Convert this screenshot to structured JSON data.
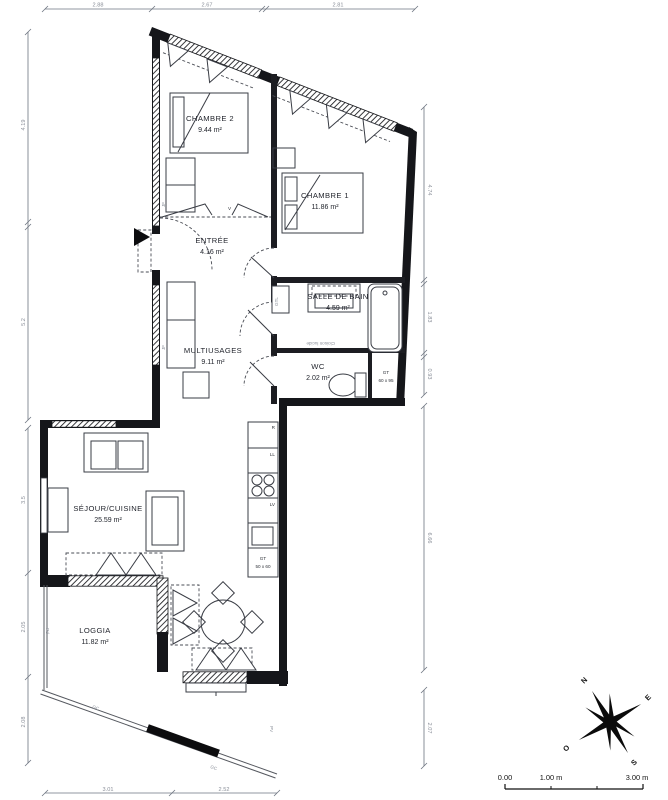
{
  "rooms": {
    "chambre2": {
      "name": "CHAMBRE 2",
      "area": "9.44 m²"
    },
    "chambre1": {
      "name": "CHAMBRE 1",
      "area": "11.86 m²"
    },
    "entree": {
      "name": "ENTRÉE",
      "area": "4.16 m²"
    },
    "salle_de_bain": {
      "name": "SALLE DE BAIN",
      "area": "4.59 m²"
    },
    "wc": {
      "name": "WC",
      "area": "2.02 m²"
    },
    "multiusages": {
      "name": "MULTIUSAGES",
      "area": "9.11 m²"
    },
    "sejour": {
      "name": "SÉJOUR/CUISINE",
      "area": "25.59 m²"
    },
    "loggia": {
      "name": "LOGGIA",
      "area": "11.82 m²"
    }
  },
  "dimensions": {
    "top": [
      "2.88",
      "2.67",
      "2.81"
    ],
    "left": [
      "4.19",
      "5.2",
      "3.5",
      "2.05",
      "2.08"
    ],
    "right": [
      "4.74",
      "1.83",
      "0.93",
      "6.66",
      "2.07"
    ],
    "bottom": [
      "3.01",
      "2.52"
    ]
  },
  "labels": {
    "gtl": "GTL",
    "jf1": "JF",
    "jf2": "JF",
    "pd": "Pd",
    "pv": "PV",
    "gc1": "GC",
    "gc2": "GC",
    "cloison": "Cloison lucide",
    "v": "V",
    "fridge": "R",
    "washer": "LL",
    "dishwasher": "LV",
    "gt_wc_1": "GT",
    "gt_wc_2": "60 x 95",
    "gt_kitchen_1": "GT",
    "gt_kitchen_2": "50 x 60"
  },
  "compass": {
    "n": "N",
    "e": "E",
    "s": "S",
    "o": "O"
  },
  "scale_bar": {
    "zero": "0.00",
    "one": "1.00 m",
    "three": "3.00 m"
  },
  "colors": {
    "wall": "#15161a",
    "dim_text": "#8a8f99",
    "room_text": "#23262e"
  }
}
